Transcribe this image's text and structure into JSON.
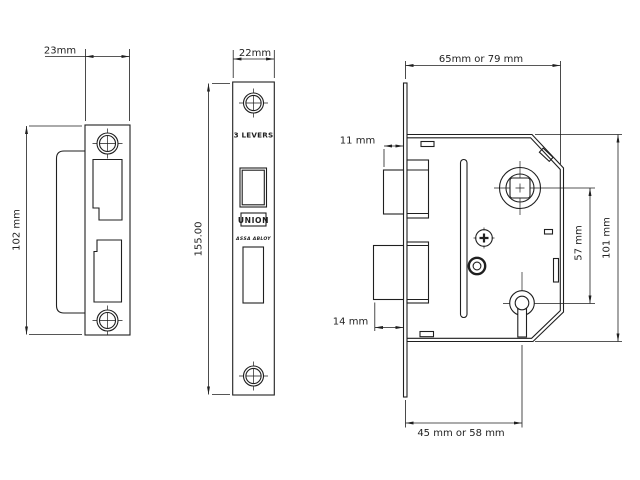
{
  "colors": {
    "line": "#1f1f1f",
    "background": "#ffffff"
  },
  "views": {
    "strike_plate": {
      "width_dim": "23mm",
      "height_dim": "102 mm"
    },
    "faceplate": {
      "width_dim": "22mm",
      "height_dim": "155.00",
      "levers_label": "3 LEVERS",
      "brand": "UNION",
      "brand_sub": "ASSA ABLOY"
    },
    "lock_case": {
      "depth_dim": "65mm or 79 mm",
      "latch_projection_dim": "11 mm",
      "bolt_projection_dim": "14 mm",
      "centres_dim": "57 mm",
      "height_dim": "101 mm",
      "backset_dim": "45 mm or 58 mm"
    }
  }
}
